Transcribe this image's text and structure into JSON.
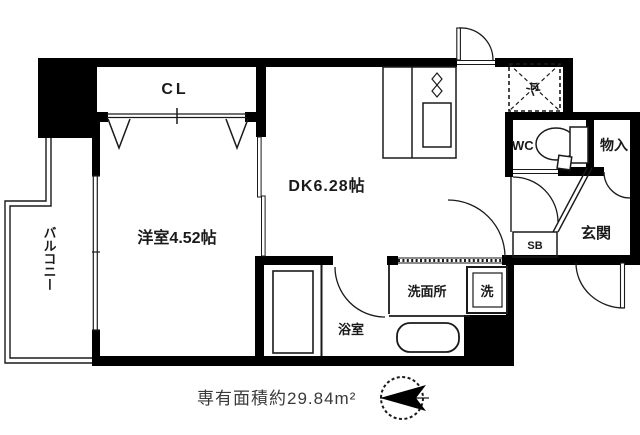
{
  "floor_plan": {
    "rooms": {
      "closet": "CL",
      "western_room": "洋室4.52帖",
      "dining_kitchen": "DK6.28帖",
      "balcony": "バルコニー",
      "bathroom": "浴室",
      "washroom": "洗面所",
      "washer": "洗",
      "toilet": "WC",
      "storage": "物入",
      "shoe_box": "SB",
      "entrance": "玄関",
      "refrigerator": "冷"
    },
    "footer": {
      "area_text": "専有面積約29.84m²"
    },
    "colors": {
      "wall": "#000000",
      "background": "#ffffff",
      "area_text": "#3a3a3a"
    }
  }
}
